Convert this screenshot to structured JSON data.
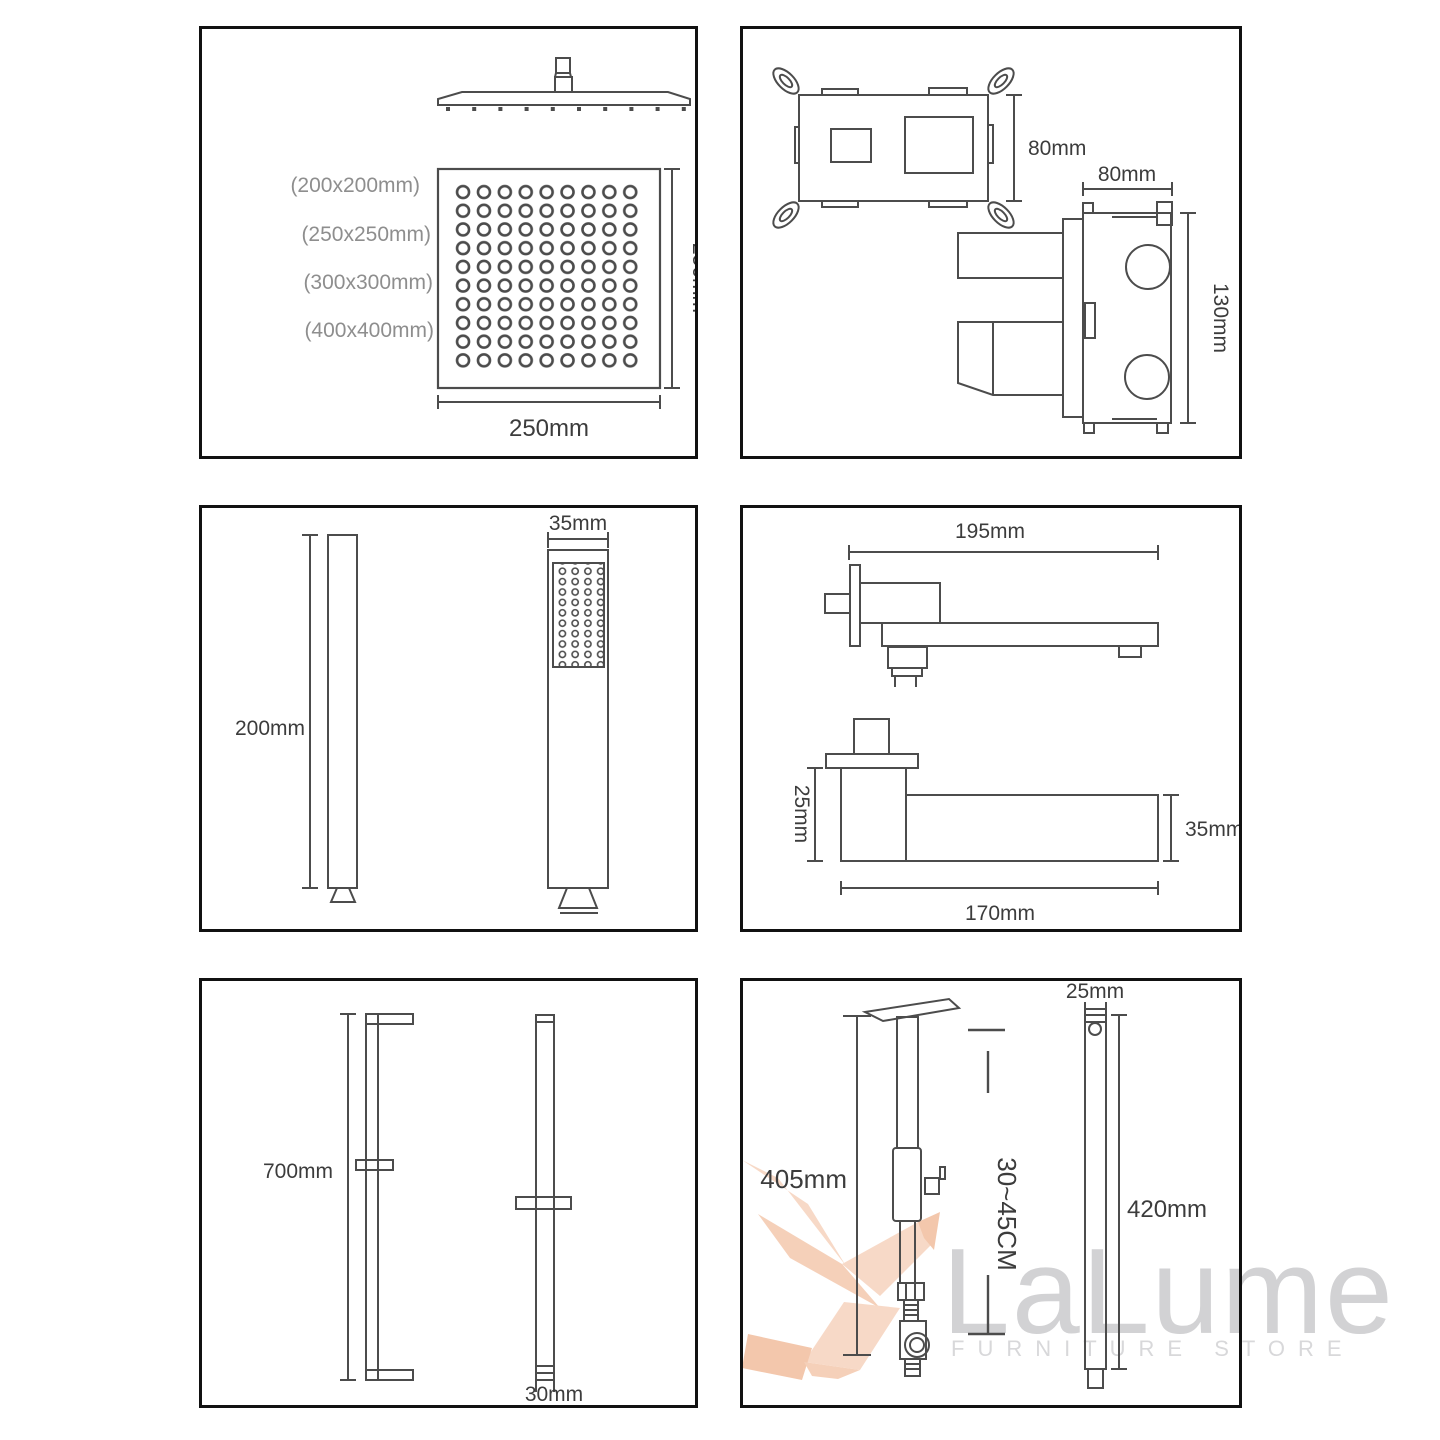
{
  "watermark": {
    "brand": "LaLume",
    "subtitle": "FURNITURE STORE",
    "brand_color": "#d2d2d4",
    "subtitle_color": "#d8d8da",
    "logo_color": "#f5cab0",
    "logo_color_dark": "#eeb08a",
    "logo_name": "hummingbird-logo"
  },
  "colors": {
    "line": "#4c4c4c",
    "dim_text": "#3c3c3c",
    "muted_text": "#8e8e8e",
    "panel_border": "#111111"
  },
  "panels": {
    "rain_shower_head": {
      "size_options": [
        "(200x200mm)",
        "(250x250mm)",
        "(300x300mm)",
        "(400x400mm)"
      ],
      "height_label": "250mm",
      "width_label": "250mm"
    },
    "valve_box": {
      "front_height_label": "80mm",
      "side_width_label": "80mm",
      "side_height_label": "130mm"
    },
    "hand_shower": {
      "length_label": "200mm",
      "width_label": "35mm"
    },
    "tub_spout": {
      "length_label": "195mm",
      "flange_height_label": "25mm",
      "arm_height_label": "35mm",
      "body_length_label": "170mm"
    },
    "slide_bar": {
      "length_label": "700mm",
      "width_label": "30mm"
    },
    "ceiling_shower_arm": {
      "length_label": "405mm",
      "adjust_range_label": "30~45CM",
      "width_label": "25mm",
      "arm_length_label": "420mm"
    }
  }
}
